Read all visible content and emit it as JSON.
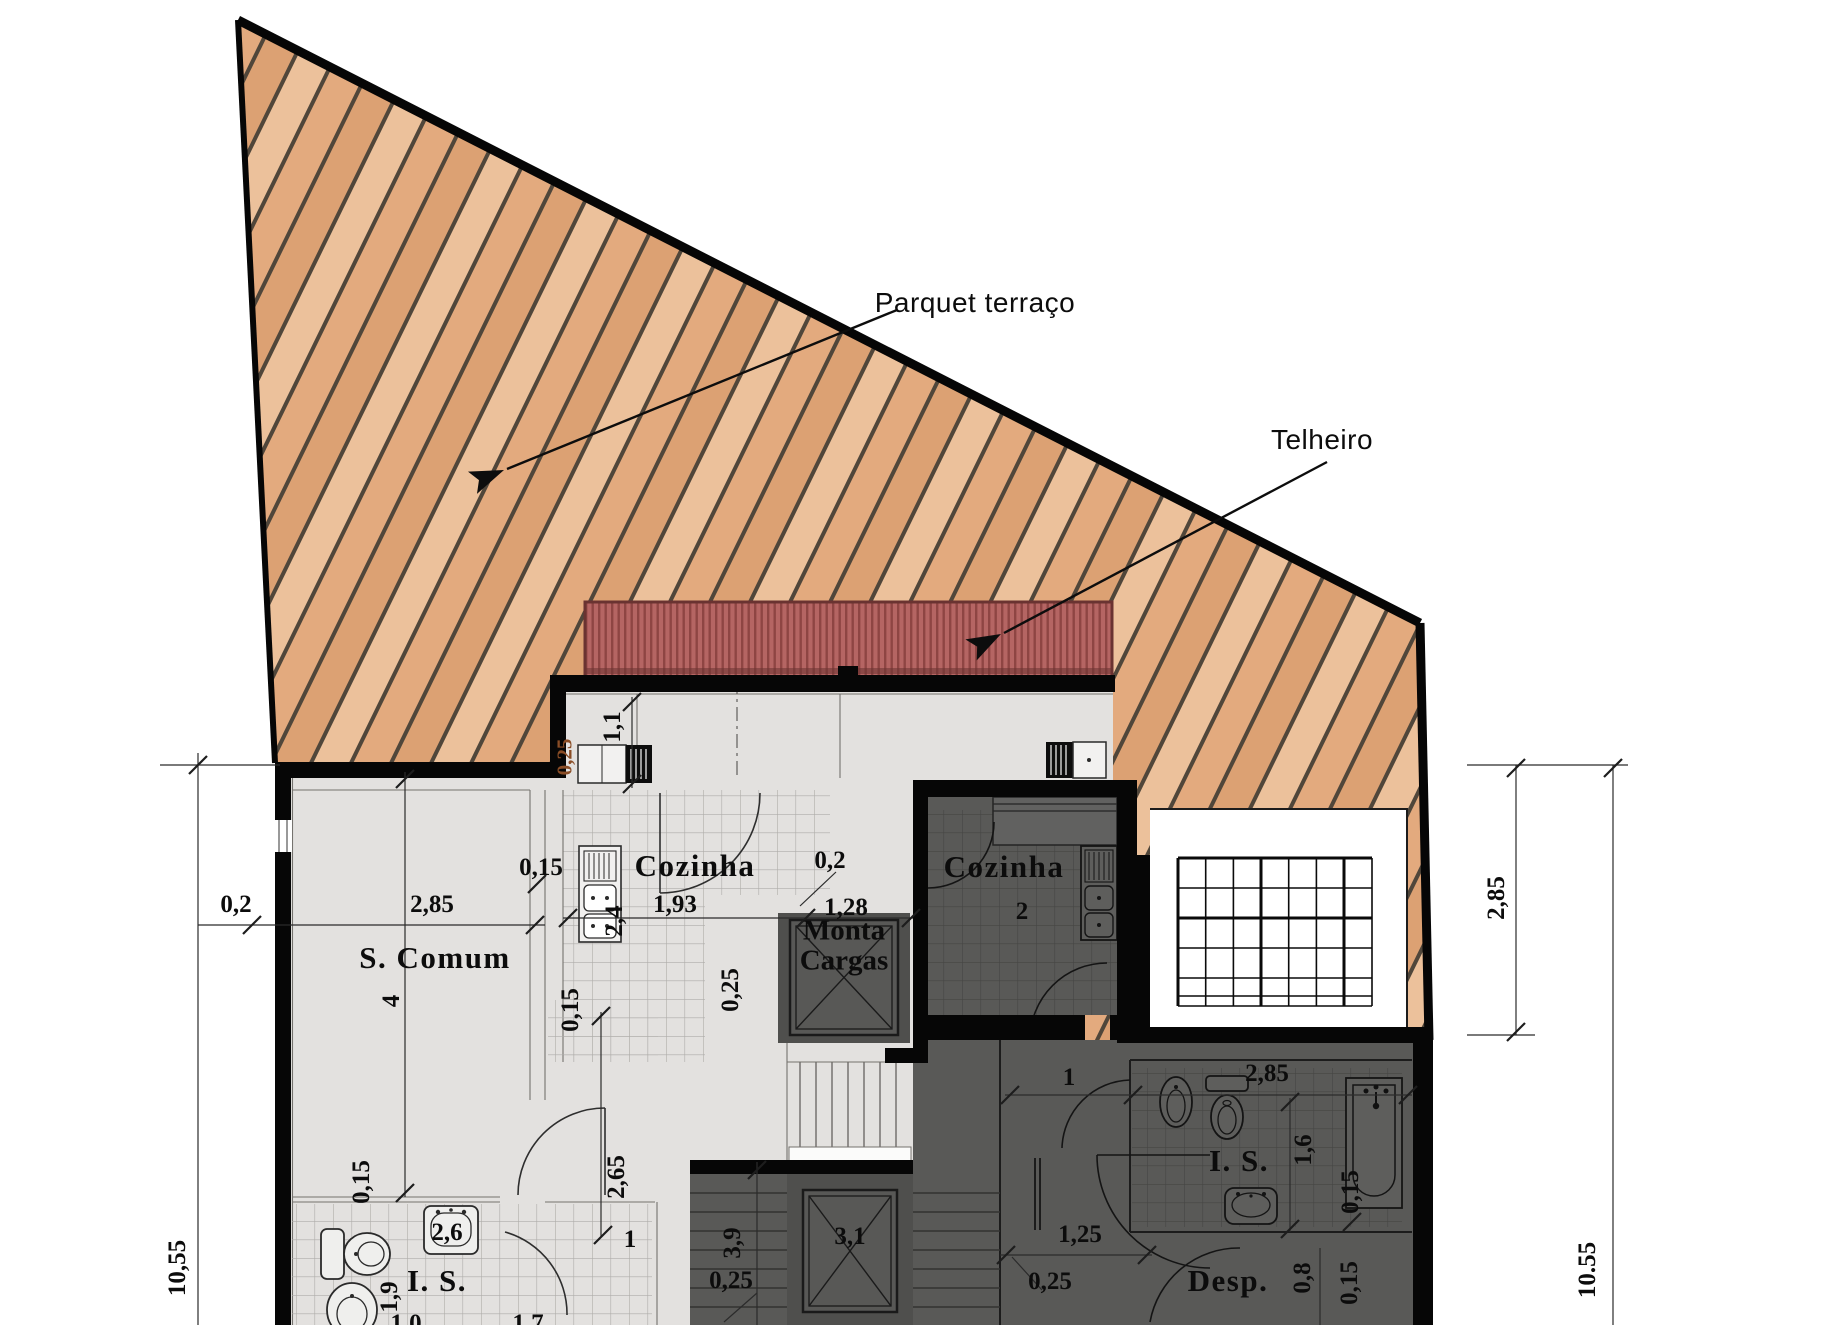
{
  "colors": {
    "wood_base": "#e3aa7e",
    "wood_mid": "#dca173",
    "wood_light": "#ecc19b",
    "wood_line": "#50463a",
    "roof_base": "#b56563",
    "roof_stripe": "#8e4543",
    "roof_edge": "#6a3331",
    "floor_light": "#e3e1df",
    "floor_dark": "#595957",
    "wall": "#060606",
    "tile_line_light": "#aeaca9",
    "tile_line_dark": "#454543",
    "patio": "#ffffff",
    "line_thin": "#3a3a3a",
    "dim_orange": "#8a4d26",
    "fixture_light": "#efefed",
    "fixture_dark": "#5e5e5c"
  },
  "annotations": {
    "parquet": "Parquet terraço",
    "telheiro": "Telheiro"
  },
  "rooms": {
    "s_comum": "S. Comum",
    "cozinha_1": "Cozinha",
    "cozinha_2": "Cozinha",
    "monta_1": "Monta",
    "monta_2": "Cargas",
    "is_1": "I. S.",
    "is_2": "I. S.",
    "desp": "Desp."
  },
  "dims": {
    "left_02": "0,2",
    "left_285": "2,85",
    "left_1055": "10,55",
    "right_285": "2,85",
    "right_1055": "10.55",
    "s_comum_4": "4",
    "wall_015_a": "0,15",
    "wall_015_b": "0,15",
    "wall_015_c": "0,15",
    "coz1_193": "1,93",
    "coz1_24": "2,4",
    "coz1_11": "1,1",
    "coz1_025": "0,25",
    "orange_025": "0,25",
    "mc_02": "0,2",
    "mc_128": "1,28",
    "coz2_2": "2",
    "corr_1": "1",
    "is2_285": "2,85",
    "is2_16": "1,6",
    "is2_015": "0,15",
    "desp_08": "0,8",
    "desp_015": "0,15",
    "corr_125": "1,25",
    "corr_025": "0,25",
    "shaft_31": "3,1",
    "stairs_39": "3,9",
    "stairs_025": "0,25",
    "hall_265": "2,65",
    "door_1": "1",
    "is1_26": "2,6",
    "is1_19": "1,9",
    "cut_10": "1,0",
    "cut_17": "1,7"
  }
}
